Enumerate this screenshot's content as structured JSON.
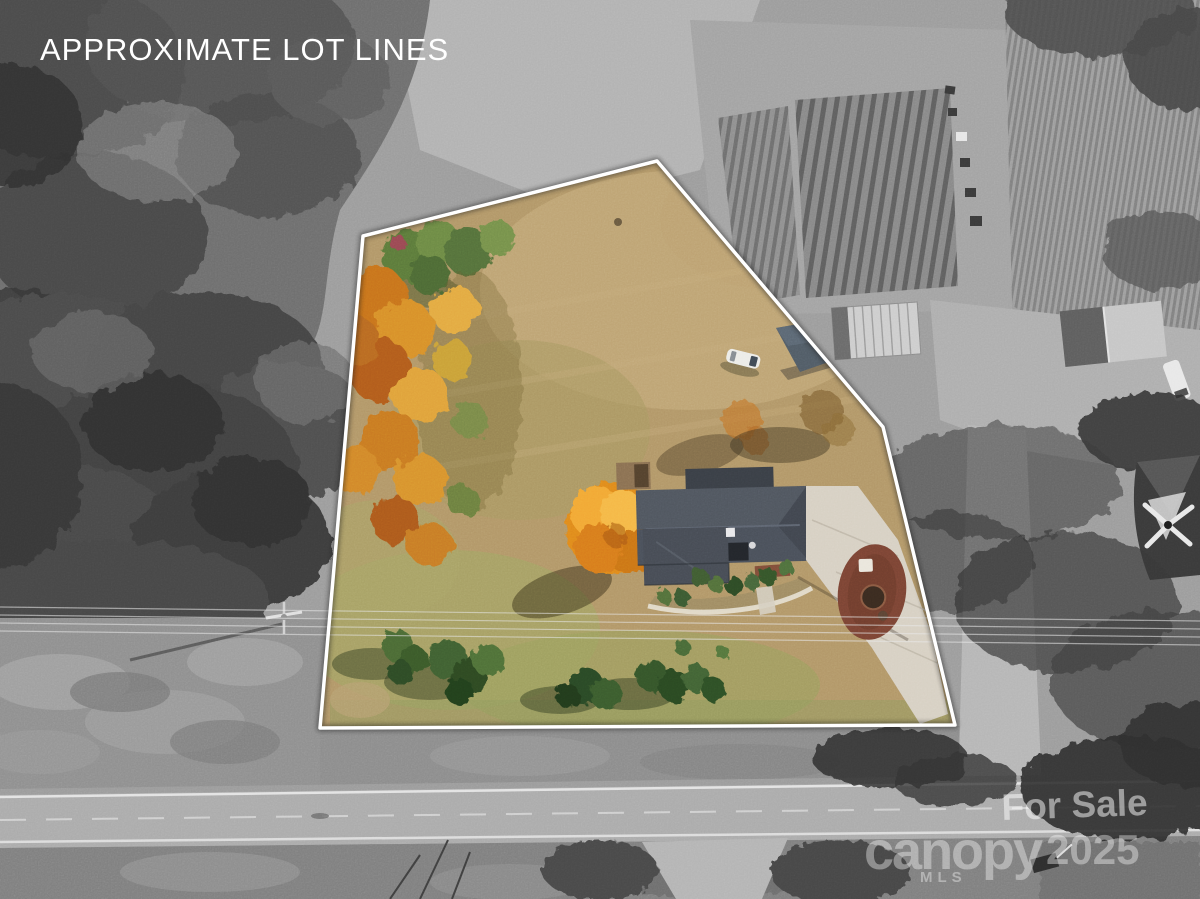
{
  "overlay": {
    "title": "APPROXIMATE LOT LINES"
  },
  "watermark": {
    "for_sale": "For Sale",
    "brand": "canopy",
    "brand_sub": "MLS",
    "year": "2025"
  },
  "lot_line": {
    "points": "657,161 883,427 955,725 320,728 363,236",
    "color": "#ffffff"
  },
  "scene": {
    "description": "Aerial drone photo of a residential lot; lot interior shown in color with house, fall trees, driveway and lawn, surroundings desaturated to grayscale with road, garden rows, sheds and neighboring houses"
  },
  "colors": {
    "background_gray": "#9c9c9c",
    "forest_dark_gray": "#4b4b4b",
    "road_asphalt": "#ababab",
    "lot_grass_tan": "#b29768",
    "fall_tree_orange": "#c8731f",
    "maple_orange": "#e08a1e",
    "house_roof_gray": "#4a505a",
    "driveway_concrete": "#d7d0c3",
    "mulch_red_brown": "#7b4434",
    "lot_line_white": "#ffffff"
  }
}
